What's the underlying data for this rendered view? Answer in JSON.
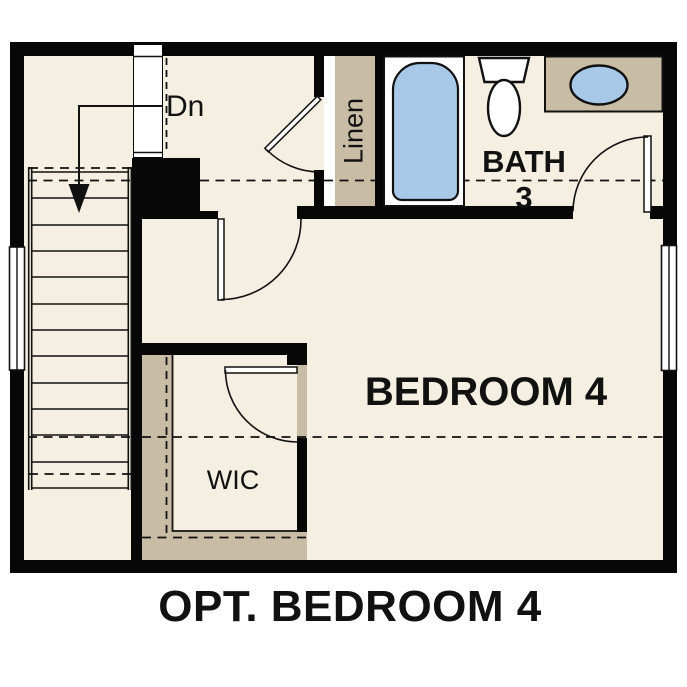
{
  "floorplan": {
    "caption": "OPT. BEDROOM 4",
    "labels": {
      "stairs_direction": "Dn",
      "linen_closet": "Linen",
      "bath_name": "BATH",
      "bath_number": "3",
      "bedroom": "BEDROOM 4",
      "walk_in_closet": "WIC"
    },
    "colors": {
      "floor": "#F5EFE2",
      "casework": "#C9BCA5",
      "fixture_blue": "#A8C8E8",
      "wall": "#070707",
      "background": "#FFFFFF",
      "text": "#111111"
    }
  }
}
